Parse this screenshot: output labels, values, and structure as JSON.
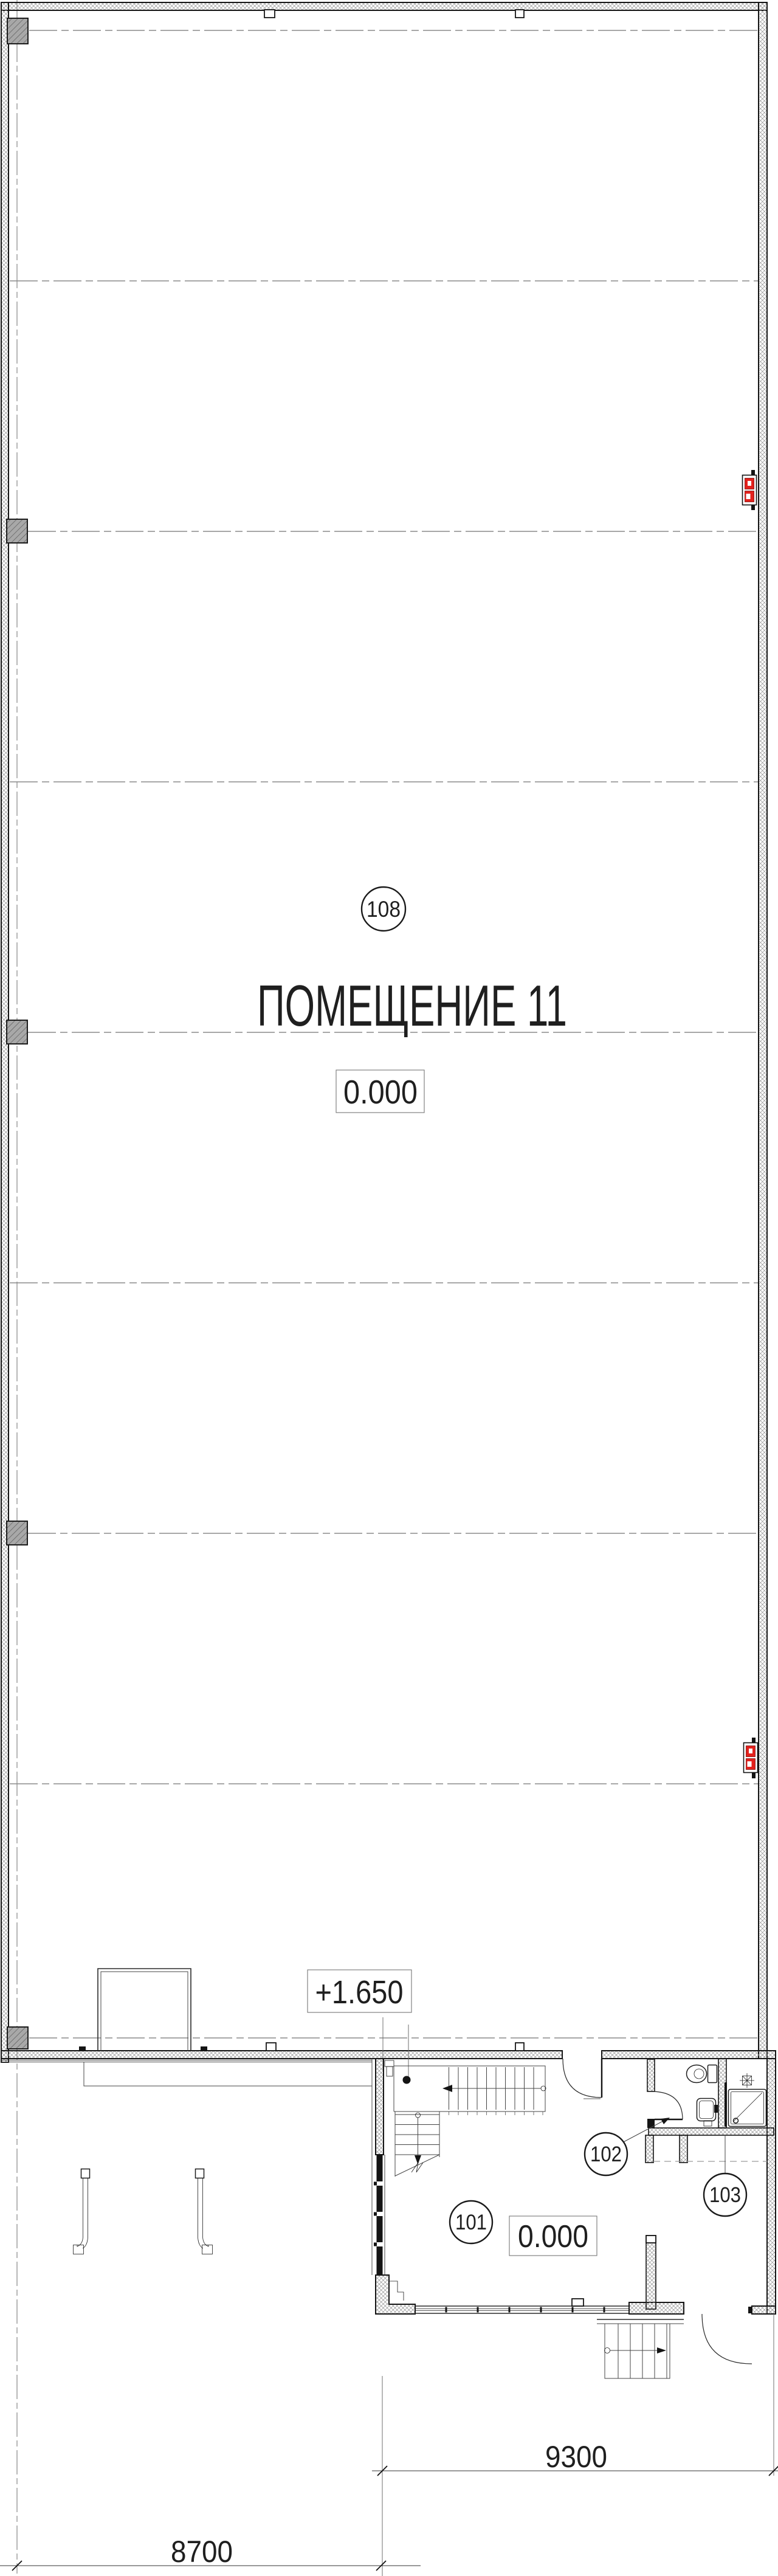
{
  "plan": {
    "main_hall": {
      "bubble": "108",
      "title": "ПОМЕЩЕНИЕ 11",
      "level": "0.000"
    },
    "annex": {
      "bubble_101": "101",
      "bubble_102": "102",
      "bubble_103": "103",
      "level": "0.000"
    },
    "dock": {
      "level": "+1.650"
    },
    "dimensions": {
      "annex_width": "9300",
      "left_bay_width": "8700"
    },
    "colors": {
      "line": "#1c1c1c",
      "grid": "#8a8a8a",
      "red": "#e3211c",
      "pilaster_fill": "#a8a8a8"
    },
    "symbols": [
      "fire-hose-cabinet",
      "wall-ladder",
      "toilet",
      "sink",
      "shower-tray",
      "floor-drain",
      "stairs",
      "dock-platform"
    ]
  }
}
